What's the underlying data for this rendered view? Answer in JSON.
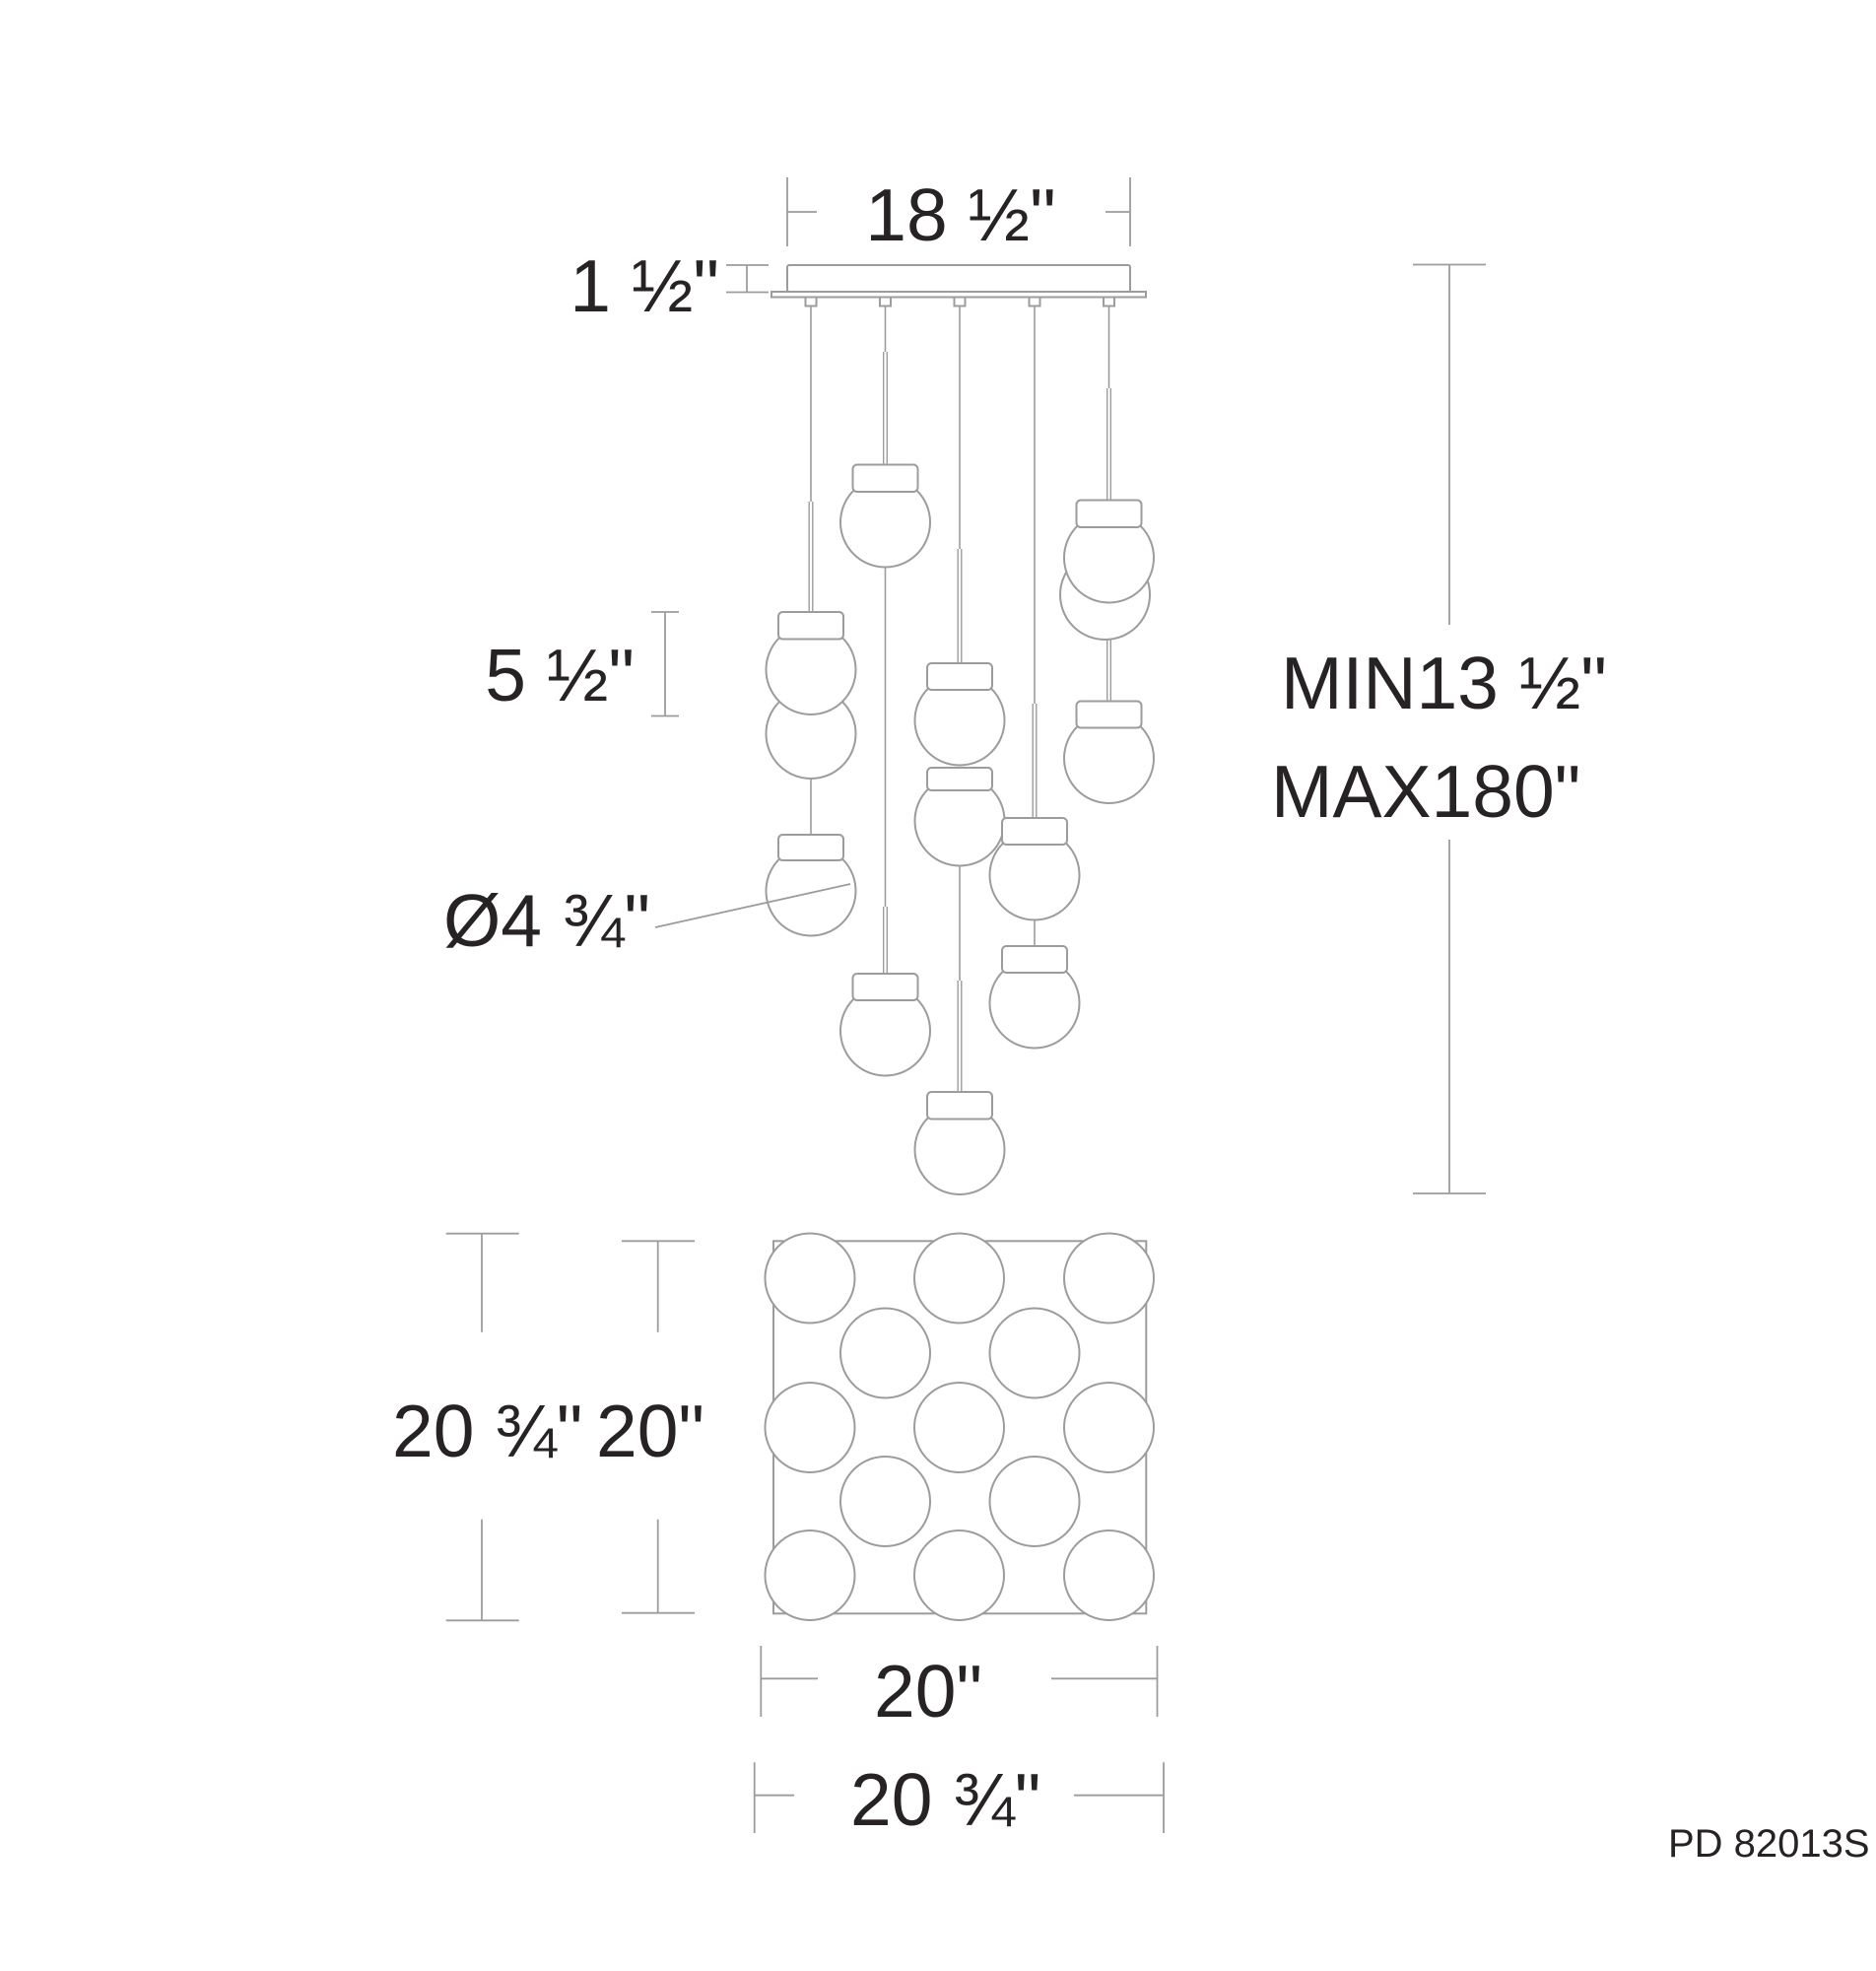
{
  "part_number": "PD 82013S",
  "dims": {
    "canopy_width": "18 ½\"",
    "canopy_height": "1 ½\"",
    "pendant_height": "5 ½\"",
    "globe_diameter": "Ø4 ¾\"",
    "min_drop": "MIN13 ½\"",
    "max_drop": "MAX180\"",
    "plan_height_outer": "20 ¾\"",
    "plan_height_inner": "20\"",
    "plan_width_inner": "20\"",
    "plan_width_outer": "20 ¾\""
  },
  "colors": {
    "line": "#9C9C9C",
    "text": "#272324"
  }
}
